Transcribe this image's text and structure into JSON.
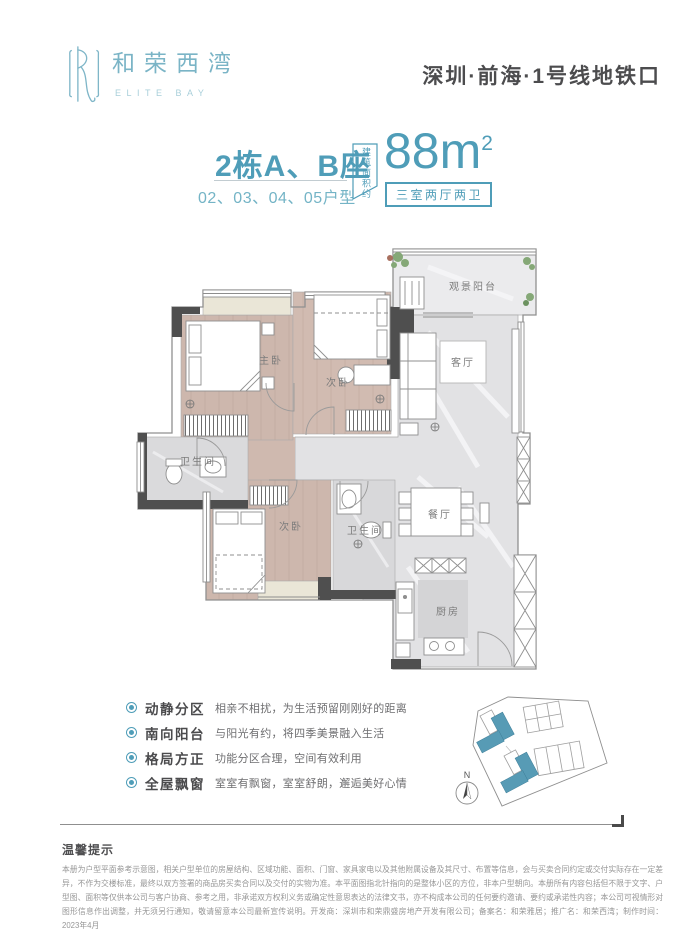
{
  "brand": {
    "name_cn": "和荣西湾",
    "name_en": "ELITE BAY"
  },
  "header": {
    "location": "深圳·前海·1号线地铁口"
  },
  "unit": {
    "building": "2栋A、B座",
    "numbers": "02、03、04、05户型",
    "area_tag": "建筑面积约",
    "area_value": "88",
    "area_unit": "m",
    "area_exp": "2",
    "spec": "三室两厅两卫"
  },
  "floorplan": {
    "rooms": {
      "master": "主卧",
      "bedroom2": "次卧",
      "balcony": "观景阳台",
      "living": "客厅",
      "bath1": "卫生间",
      "bedroom3": "次卧",
      "bath2": "卫生间",
      "dining": "餐厅",
      "kitchen": "厨房"
    }
  },
  "features": [
    {
      "label": "动静分区",
      "desc": "相亲不相扰，为生活预留刚刚好的距离"
    },
    {
      "label": "南向阳台",
      "desc": "与阳光有约，将四季美景融入生活"
    },
    {
      "label": "格局方正",
      "desc": "功能分区合理，空间有效利用"
    },
    {
      "label": "全屋飘窗",
      "desc": "室室有飘窗，室室舒朗，邂逅美好心情"
    }
  ],
  "siteplan": {
    "compass_label": "N"
  },
  "notice": {
    "title": "温馨提示",
    "body": "本册为户型平面参考示意图，相关户型单位的房屋结构、区域功能、面积、门窗、家具家电以及其他附属设备及其尺寸、布置等信息，会与买卖合同约定或交付实际存在一定差异，不作为交楼标准，最终以双方签署的商品房买卖合同以及交付的实物为准。本平面图指北针指向的是整体小区的方位，非本户型朝向。本册所有内容包括但不限于文字、户型图、面积等仅供本公司与客户协商、参考之用，非承诺双方权利义务或确定性意思表达的法律文书，亦不构成本公司的任何要约邀请、要约或承诺性内容；本公司可视情形对图形信息作出调整，并无须另行通知，敬请留意本公司最新宣传说明。开发商：深圳市和荣鼎盛房地产开发有限公司；备案名：和荣雅居；推广名：和荣西湾；制作时间：2023年4月"
  },
  "colors": {
    "accent": "#4f9db8",
    "accent_light": "#79b5c7",
    "wood": "#cdb7ad",
    "marble": "#e3e3e5"
  }
}
